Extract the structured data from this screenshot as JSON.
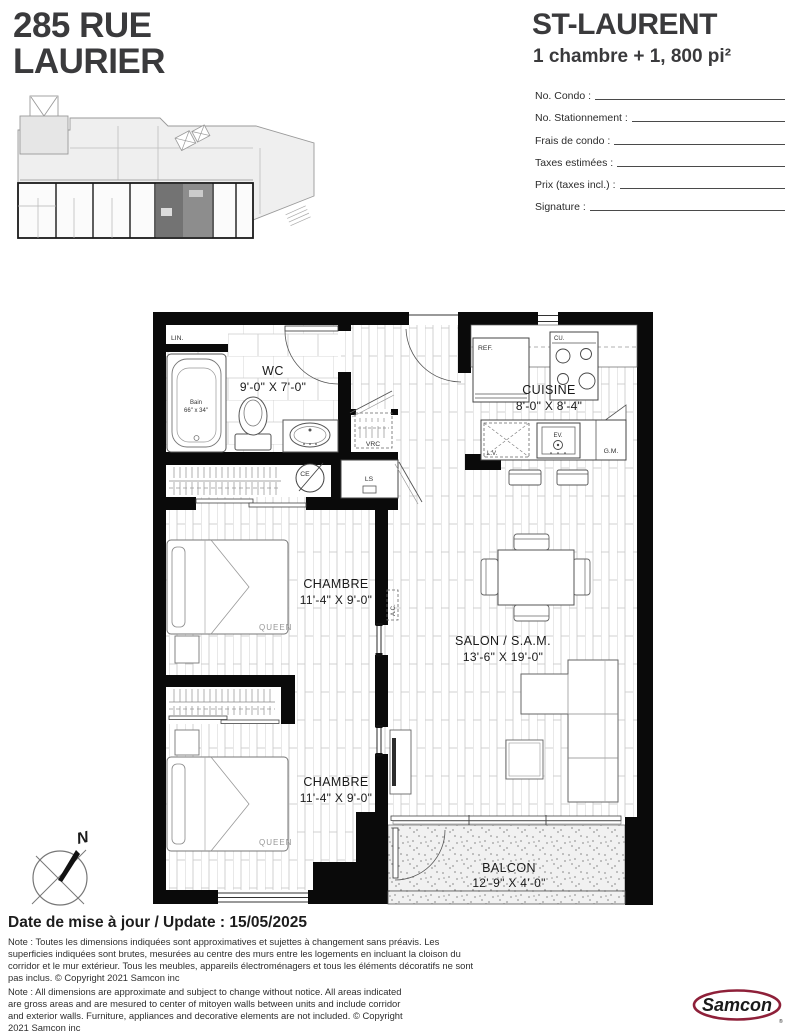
{
  "doc": {
    "address_line1": "285 RUE",
    "address_line2": "LAURIER",
    "model_name": "ST-LAURENT",
    "model_spec": "1 chambre + 1, 800 pi²"
  },
  "form": {
    "no_condo": "No. Condo :",
    "no_stationnement": "No. Stationnement :",
    "frais_condo": "Frais de condo :",
    "taxes": "Taxes estimées :",
    "prix": "Prix (taxes incl.) :",
    "signature": "Signature :"
  },
  "plan": {
    "wc_name": "WC",
    "wc_dims": "9'-0\" X 7'-0\"",
    "cuisine_name": "CUISINE",
    "cuisine_dims": "8'-0\" X 8'-4\"",
    "chambre1_name": "CHAMBRE",
    "chambre1_dims": "11'-4\" X 9'-0\"",
    "salon_name": "SALON / S.A.M.",
    "salon_dims": "13'-6\" X 19'-0\"",
    "chambre2_name": "CHAMBRE",
    "chambre2_dims": "11'-4\" X 9'-0\"",
    "balcon_name": "BALCON",
    "balcon_dims": "12'-9\" X 4'-0\"",
    "labels": {
      "lin": "LIN.",
      "bain": "Bain",
      "bain_size": "66\" x 34\"",
      "vrc": "VRC",
      "ce": "CE",
      "ls": "LS",
      "ac": "A.C.",
      "ref": "REF.",
      "cu": "CU.",
      "lv": "L.V.",
      "ev": "EV.",
      "gm": "G.M.",
      "queen1": "QUEEN",
      "queen2": "QUEEN"
    }
  },
  "compass": {
    "north": "N"
  },
  "footer": {
    "date_line": "Date de mise à jour / Update : 15/05/2025",
    "note_fr": "Note : Toutes les dimensions indiquées sont approximatives et sujettes à changement sans préavis. Les superficies indiquées sont brutes, mesurées au centre des murs entre les logements en incluant la cloison du corridor et le mur extérieur. Tous les meubles, appareils électroménagers et tous les éléments décoratifs ne sont pas inclus. © Copyright 2021 Samcon inc",
    "note_en": "Note : All dimensions are approximate and subject to change without notice. All areas indicated are gross areas and are mesured to center of mitoyen walls between units and include corridor and exterior walls. Furniture, appliances and decorative elements are not included. © Copyright 2021 Samcon inc",
    "logo": "Samcon"
  },
  "colors": {
    "title": "#3a3a3c",
    "logo_red": "#8e2039",
    "wall": "#0a0a0a"
  }
}
